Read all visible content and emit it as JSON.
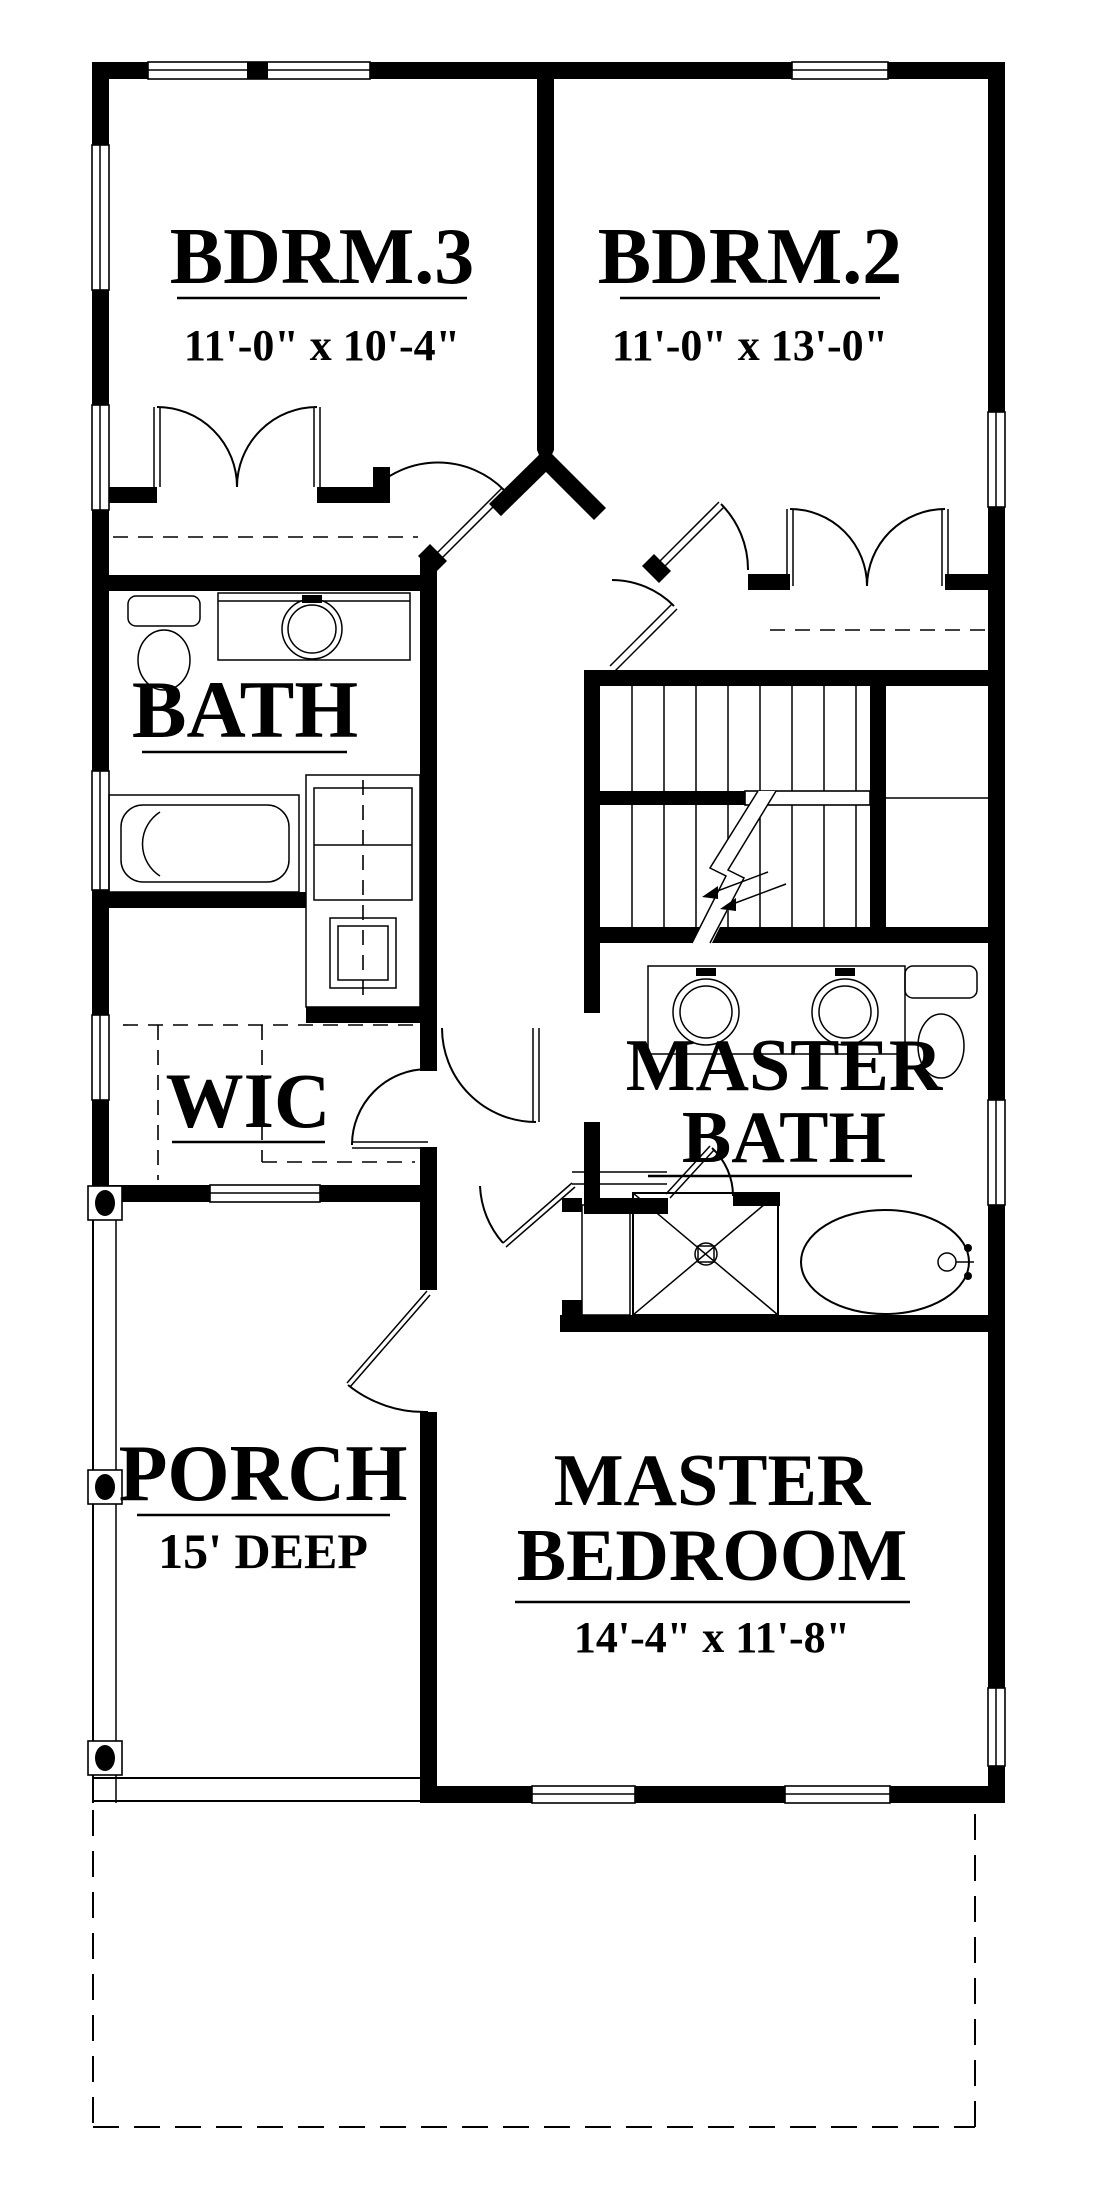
{
  "plan": {
    "type": "floor-plan",
    "colors": {
      "wall": "#000000",
      "background": "#ffffff",
      "text": "#000000"
    },
    "rooms": {
      "bdrm3": {
        "label": "BDRM.3",
        "dims": "11'-0\" x 10'-4\""
      },
      "bdrm2": {
        "label": "BDRM.2",
        "dims": "11'-0\" x 13'-0\""
      },
      "bath": {
        "label": "BATH"
      },
      "wic": {
        "label": "WIC"
      },
      "master_bath": {
        "line1": "MASTER",
        "line2": "BATH"
      },
      "porch": {
        "label": "PORCH",
        "dims": "15' DEEP"
      },
      "master_bedroom": {
        "line1": "MASTER",
        "line2": "BEDROOM",
        "dims": "14'-4\" x 11'-8\""
      }
    }
  }
}
